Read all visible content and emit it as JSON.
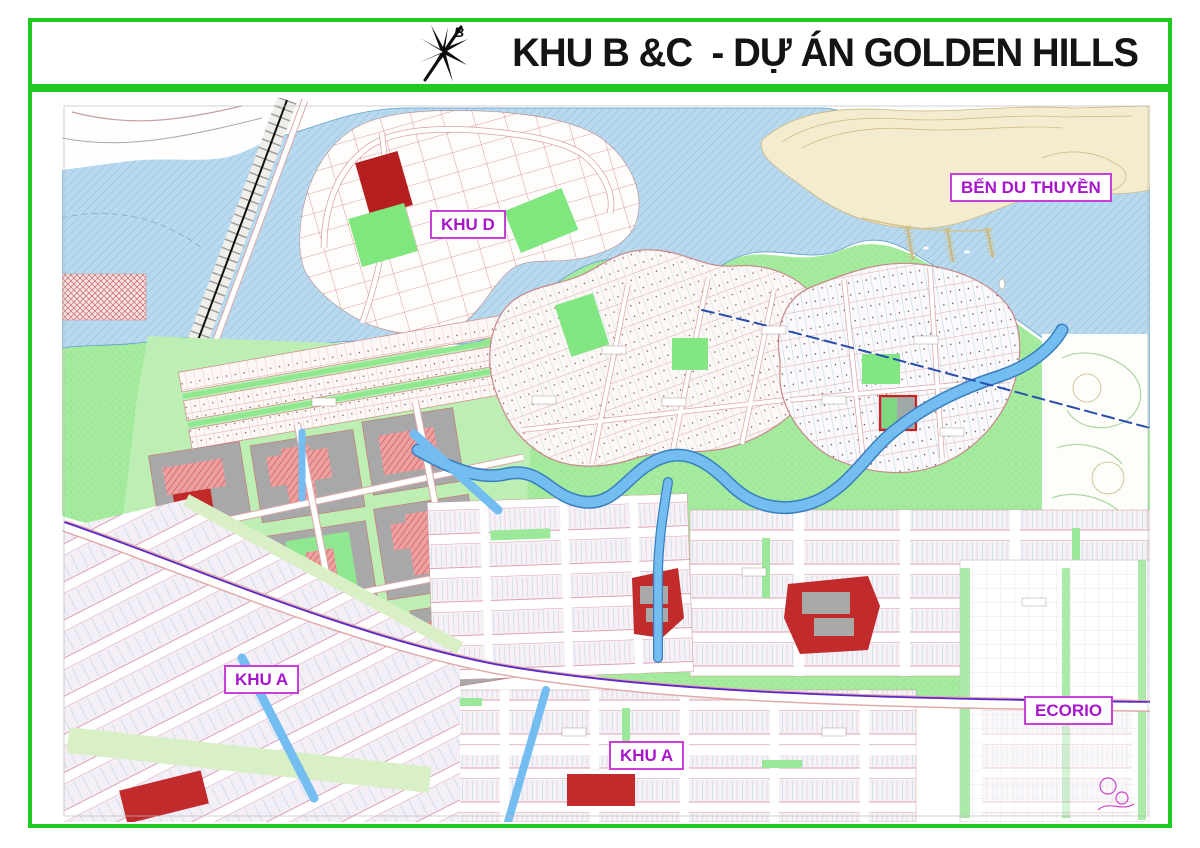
{
  "header": {
    "title": "KHU B &C  - DỰ ÁN GOLDEN HILLS",
    "logo_letter": "B"
  },
  "map_labels": {
    "khu_d": "KHU D",
    "ben_du_thuyen": "BẾN DU THUYỀN",
    "khu_a_left": "KHU A",
    "khu_a_bottom": "KHU A",
    "ecorio": "ECORIO"
  },
  "colors": {
    "frame_green": "#1ecb1e",
    "label_magenta": "#a816cc",
    "title_black": "#141414",
    "water_blue": "#b9d9ee",
    "river_blue": "#74bdf0",
    "park_green": "#a5eb9e",
    "block_green": "#7fe77d",
    "lot_line_red": "#d89494",
    "building_grey": "#a8a8a8",
    "solid_red": "#c22b2b",
    "marina_tan": "#f4ecce",
    "boundary_purple": "#5a28c8"
  }
}
